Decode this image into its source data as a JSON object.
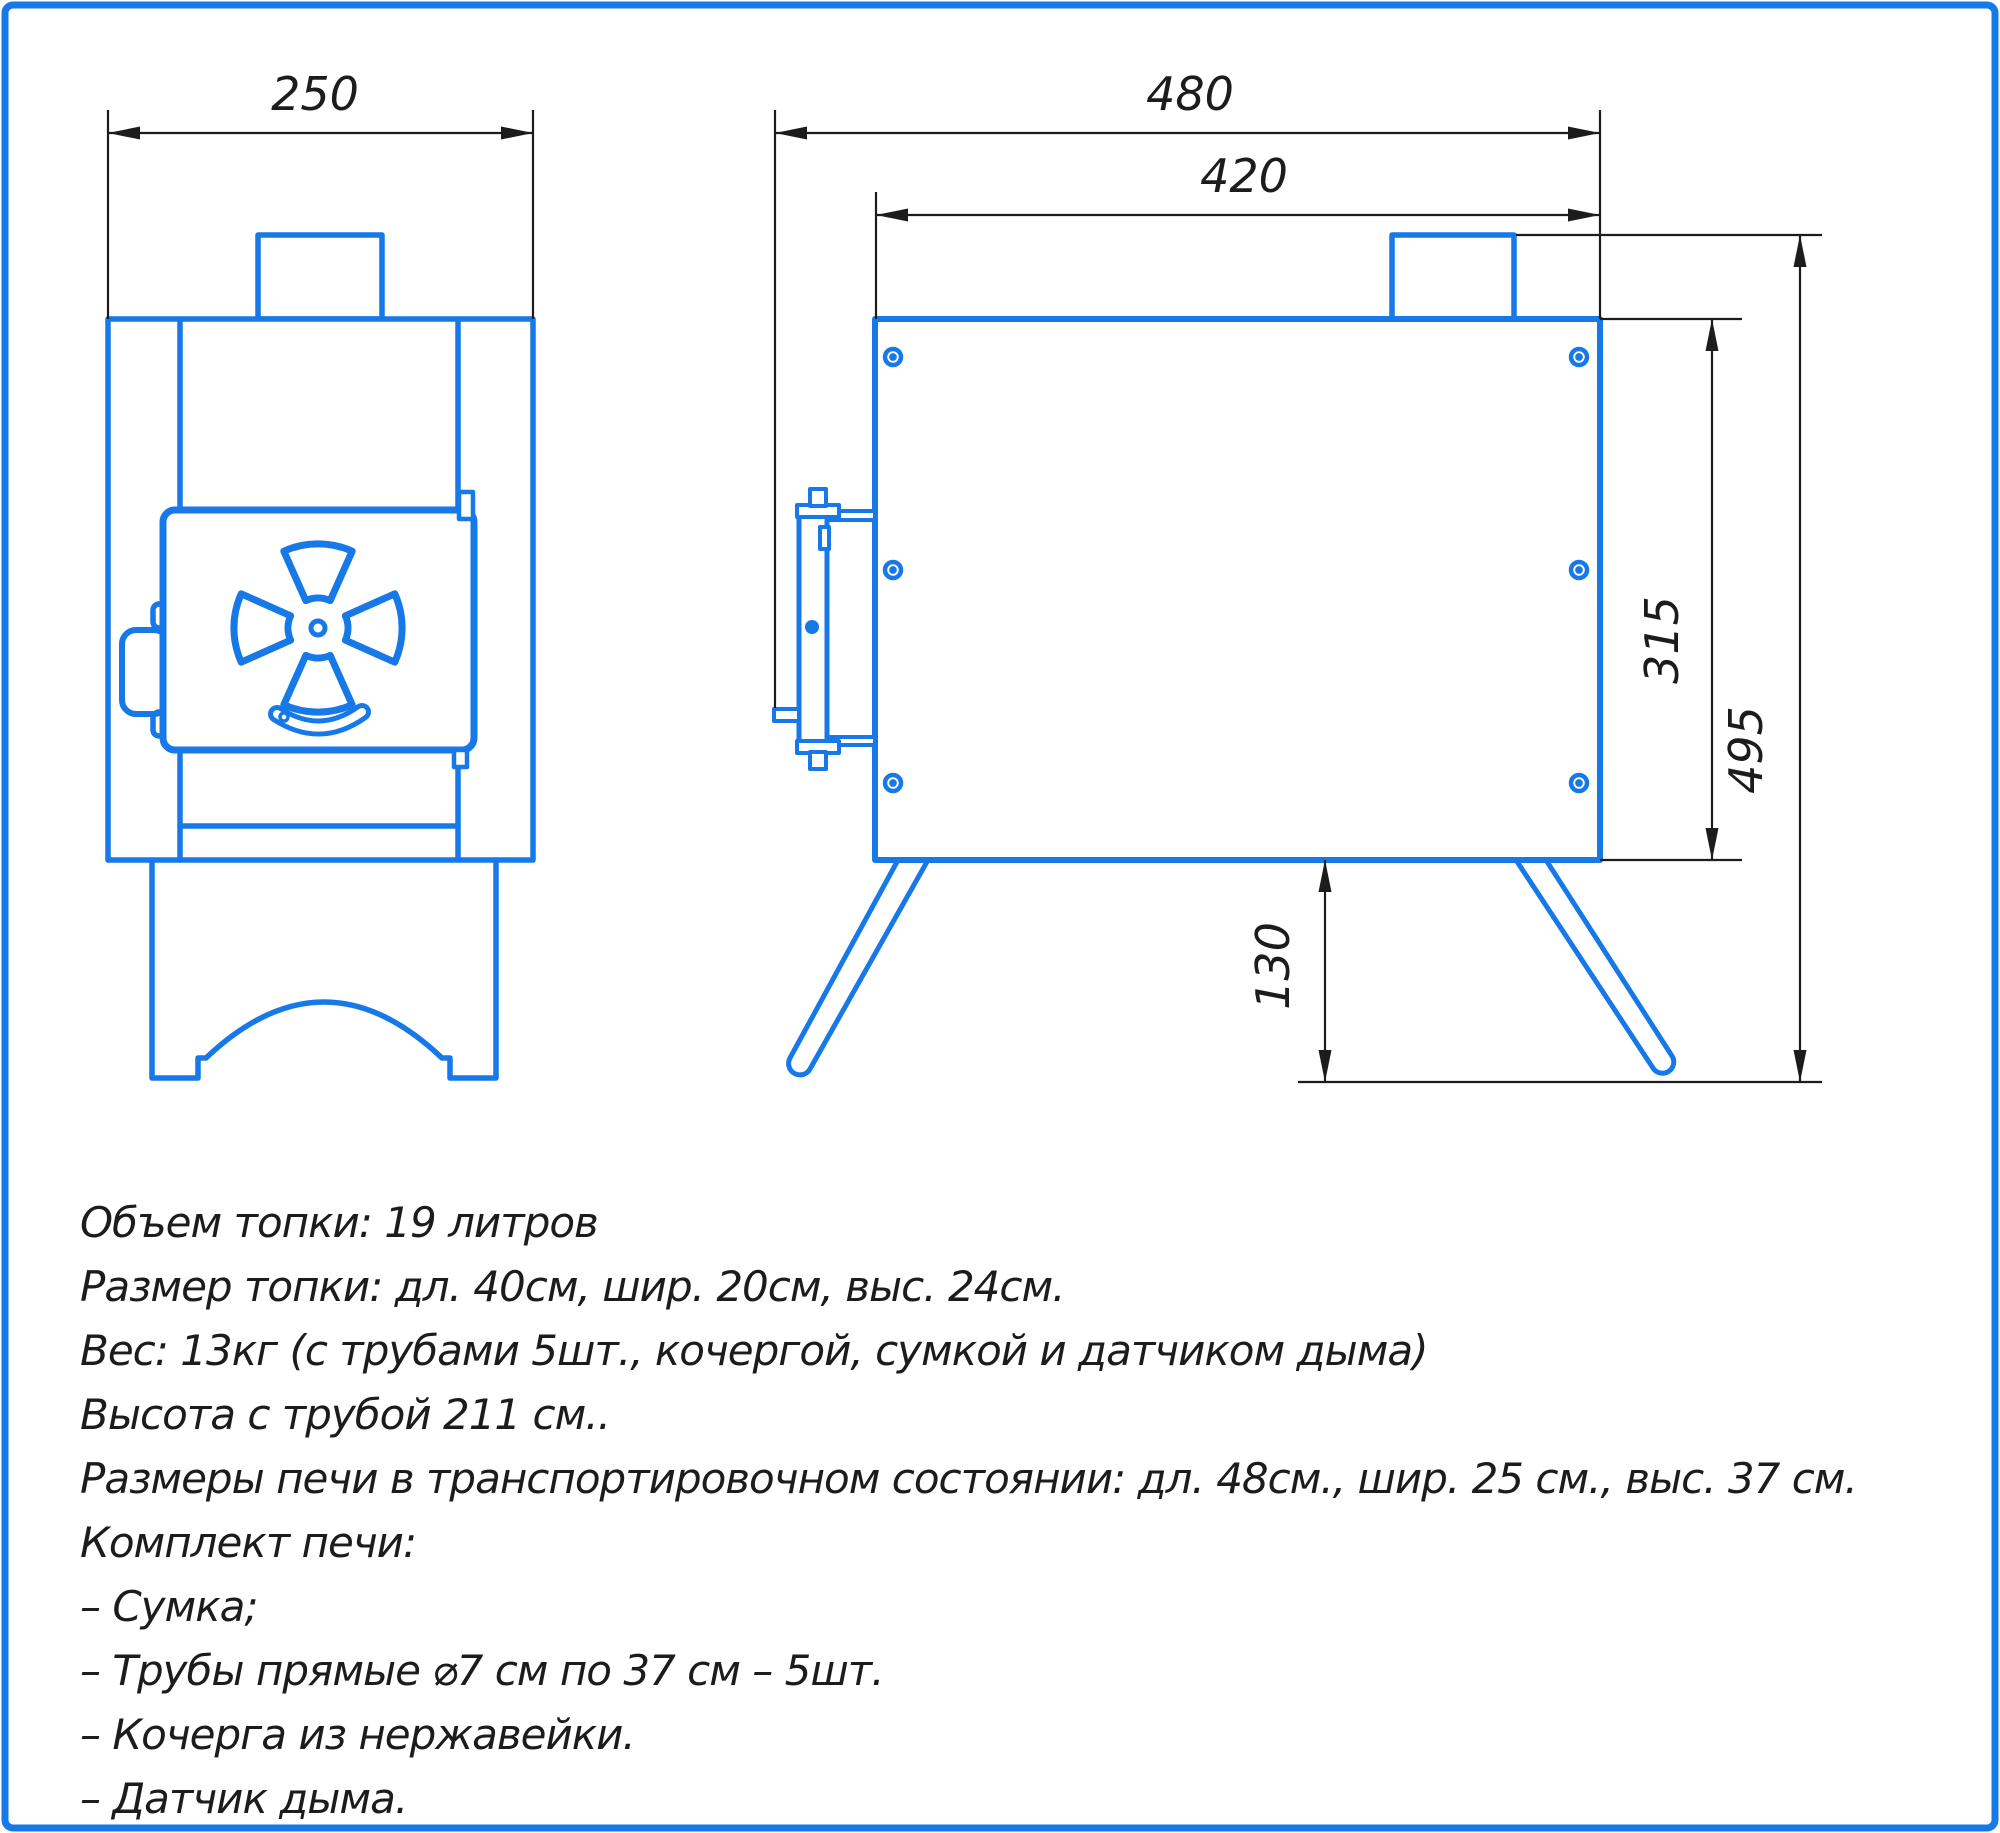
{
  "drawing": {
    "type": "technical-drawing",
    "subject": "camp wood stove, two orthographic views",
    "colors": {
      "accent_blue": "#1778E8",
      "dimension_black": "#1c1c1c",
      "background": "#ffffff"
    },
    "dimensions": {
      "front_width": "250",
      "overall_length": "480",
      "body_length": "420",
      "body_height": "315",
      "overall_height": "495",
      "leg_height": "130"
    },
    "specs": [
      "Объем топки: 19 литров",
      "Размер топки: дл. 40см, шир. 20см, выс. 24см.",
      "Вес: 13кг (с трубами 5шт., кочергой, сумкой и датчиком дыма)",
      "Высота с трубой 211 см..",
      "Размеры печи в транспортировочном состоянии: дл. 48см., шир. 25 см., выс. 37 см.",
      "Комплект печи:",
      "– Сумка;",
      "– Трубы прямые ⌀7 см по 37 см – 5шт.",
      "– Кочерга из нержавейки.",
      "– Датчик дыма."
    ]
  }
}
